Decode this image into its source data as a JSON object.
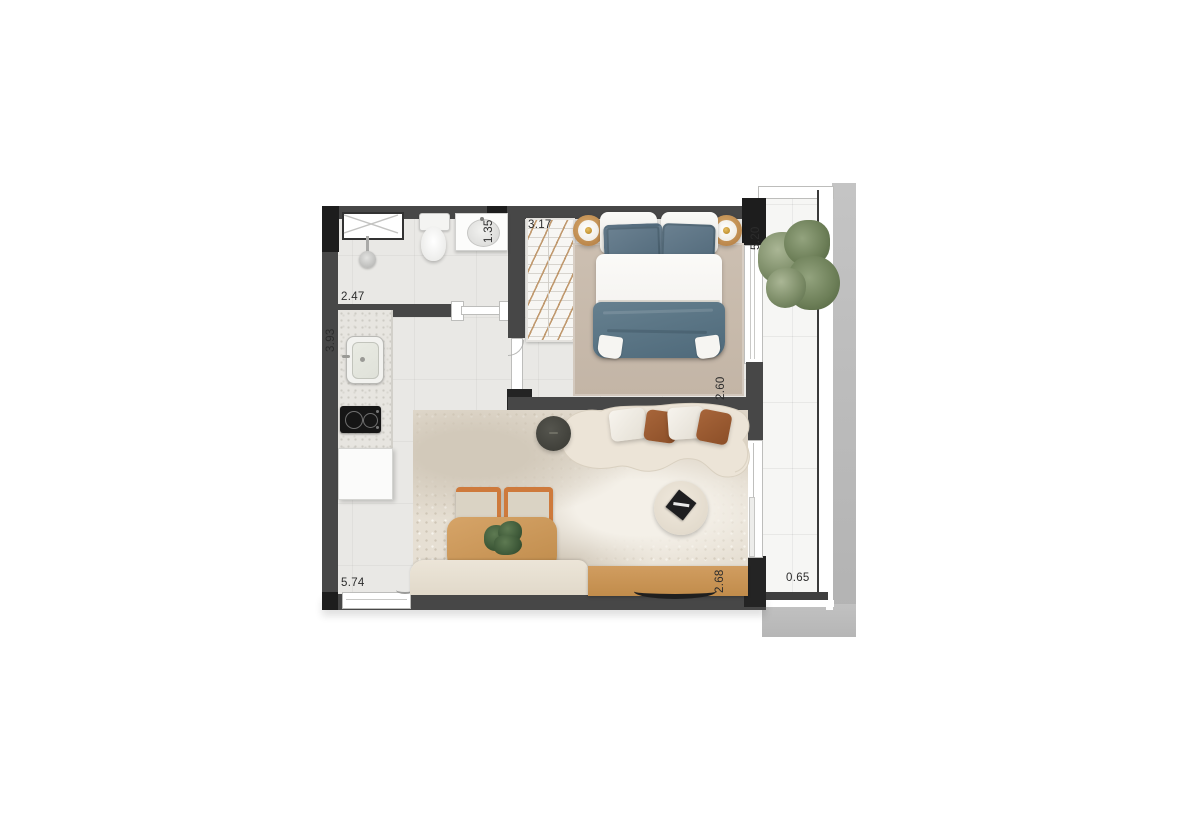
{
  "floor_plan": {
    "dimension_labels": {
      "bath_width": "2.47",
      "kitchen_run": "3.93",
      "vanity_width": "1.35",
      "closet_run": "3.17",
      "balcony_length": "5.20",
      "bedroom_width": "2.60",
      "living_run": "5.74",
      "living_width": "2.68",
      "balcony_depth": "0.65"
    },
    "colors": {
      "wall": "#474747",
      "structural_black": "#1d1d1d",
      "floor_tile": "#e9e8e5",
      "wood": "#c9965a",
      "textile_blue": "#5d7585",
      "pillow_rust": "#9c5a31",
      "sofa_cream": "#ebe3d6",
      "rug_tan": "#c8bbac",
      "balcony_concrete": "#bcbcbc",
      "plant_green": "#7e9070"
    }
  }
}
